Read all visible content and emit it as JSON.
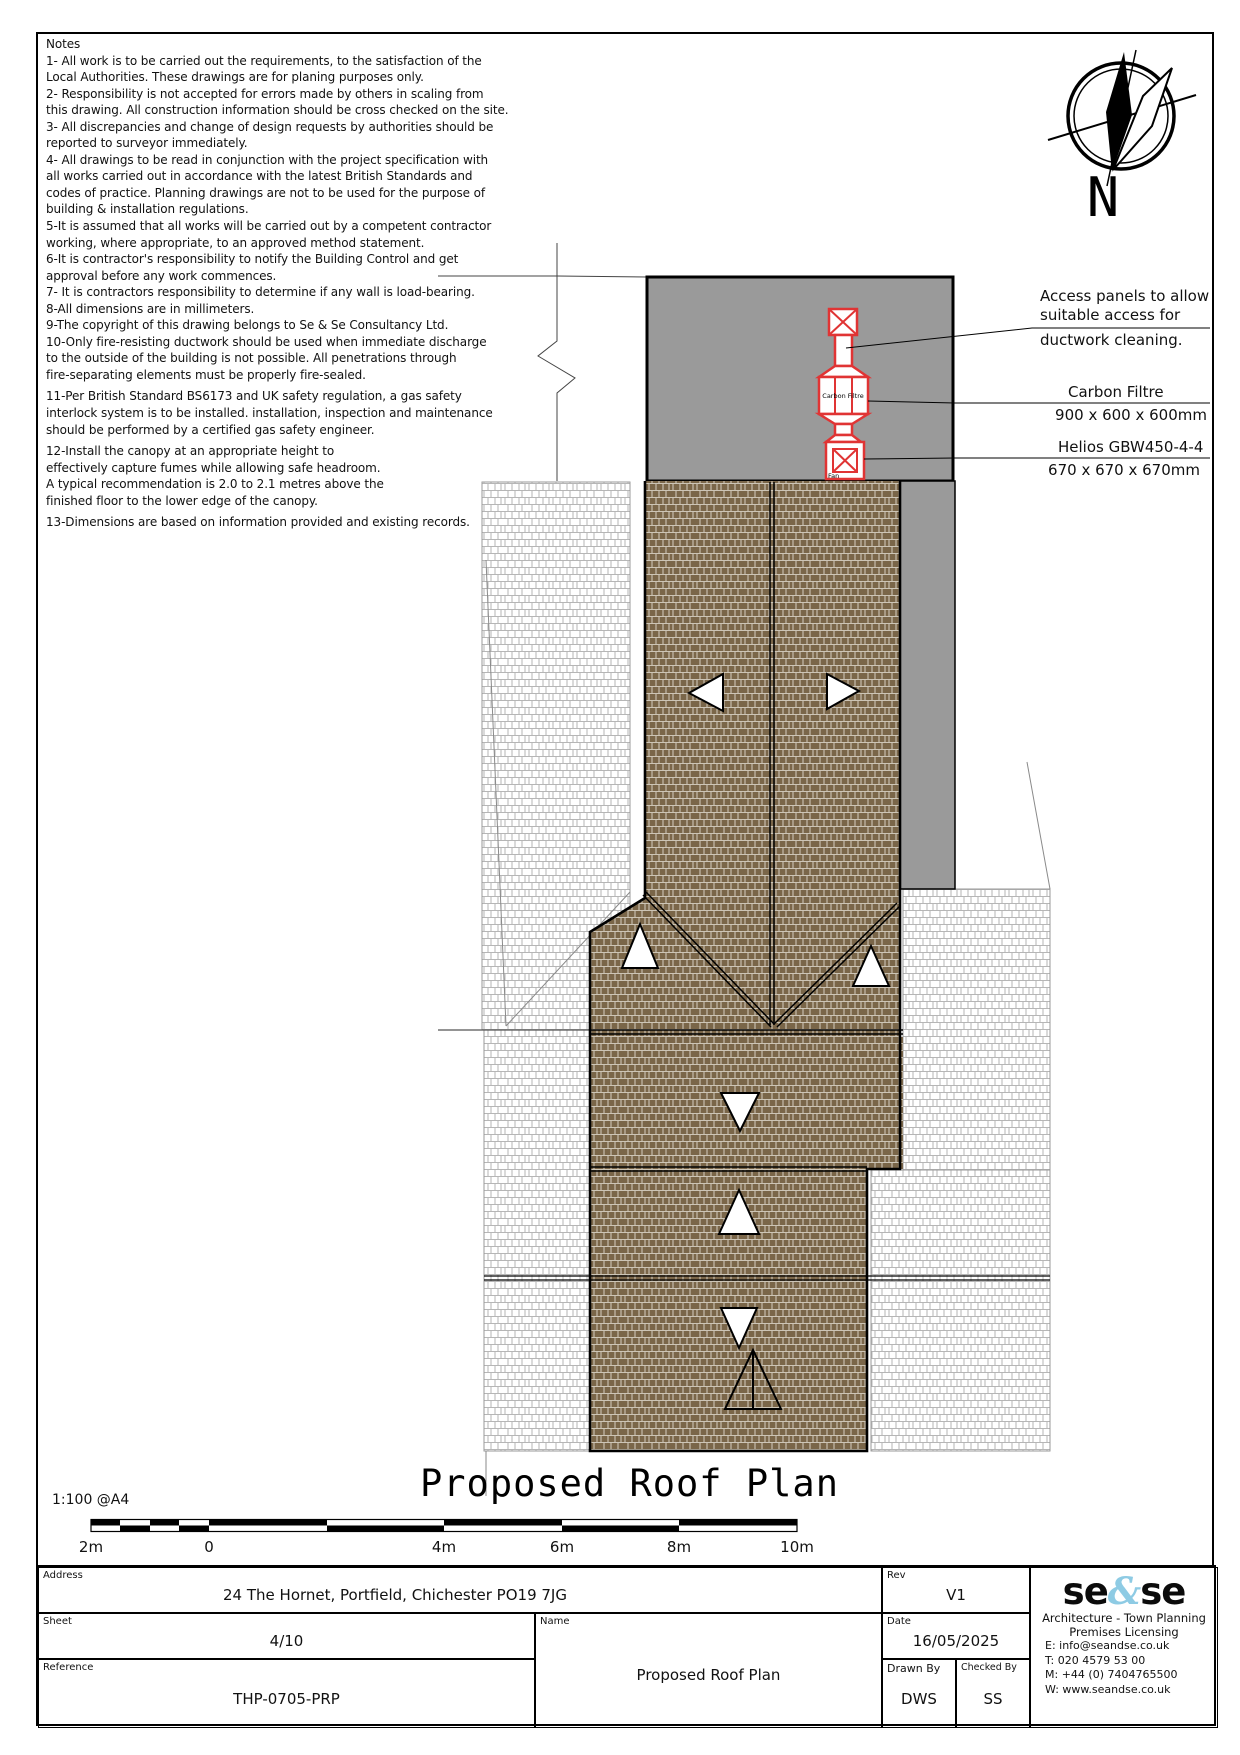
{
  "notes": {
    "title": "Notes",
    "lines": [
      "1- All work is to be carried out the requirements, to the satisfaction of the",
      "Local Authorities. These drawings are for planing purposes only.",
      "2- Responsibility is not accepted for errors made by others in scaling from",
      "this drawing. All construction information should be cross checked on the site.",
      "3- All discrepancies and change of design requests by authorities should be",
      "reported to surveyor immediately.",
      "4- All drawings to be read in conjunction with the project specification with",
      "all works carried out in accordance with the latest British Standards and",
      "codes of practice. Planning drawings are not to be used for the purpose of",
      "building & installation regulations.",
      "5-It is assumed that all works will be carried out by a competent contractor",
      "working, where appropriate, to an approved method statement.",
      "6-It is contractor's responsibility to notify the Building Control and get",
      "approval before any work commences.",
      "7- It is contractors responsibility to determine if any wall is load-bearing.",
      "8-All dimensions are in millimeters.",
      "9-The copyright of this drawing belongs to Se & Se Consultancy Ltd.",
      "10-Only fire-resisting ductwork should be used when immediate discharge",
      "to the outside of the building is not possible. All penetrations through",
      "fire-separating elements must be properly fire-sealed.",
      "11-Per British Standard BS6173 and UK safety regulation, a gas safety",
      "interlock system is to be installed. installation, inspection and maintenance",
      "should be performed by a certified gas safety engineer.",
      "12-Install the canopy at an appropriate height to",
      "effectively capture fumes while allowing safe headroom.",
      "A typical recommendation is 2.0 to 2.1 metres above the",
      "finished floor to the lower edge of the canopy.",
      "13-Dimensions are based on information provided and existing records."
    ]
  },
  "compass": {
    "label": "N"
  },
  "annotations": {
    "access_line1": "Access panels to allow",
    "access_line2": "suitable access for",
    "access_line3": "ductwork cleaning.",
    "carbon_name": "Carbon Filtre",
    "carbon_dims": "900 x 600 x 600mm",
    "fan_name": "Helios GBW450-4-4",
    "fan_dims": "670 x 670 x 670mm"
  },
  "plan_labels": {
    "carbon_filtre": "Carbon Filtre",
    "fan": "Fan"
  },
  "drawing_title": "Proposed Roof Plan",
  "scale": {
    "caption": "1:100 @A4",
    "labels": [
      "2m",
      "0",
      "4m",
      "6m",
      "8m",
      "10m"
    ]
  },
  "title_block": {
    "address_label": "Address",
    "address": "24 The Hornet, Portfield, Chichester PO19 7JG",
    "sheet_label": "Sheet",
    "sheet": "4/10",
    "reference_label": "Reference",
    "reference": "THP-0705-PRP",
    "name_label": "Name",
    "name": "Proposed Roof Plan",
    "rev_label": "Rev",
    "rev": "V1",
    "date_label": "Date",
    "date": "16/05/2025",
    "drawn_by_label": "Drawn By",
    "drawn_by": "DWS",
    "checked_by_label": "Checked By",
    "checked_by": "SS",
    "company": {
      "logo_left": "se",
      "logo_amp": "&",
      "logo_right": "se",
      "tagline1": "Architecture - Town Planning",
      "tagline2": "Premises Licensing",
      "email": "E: info@seandse.co.uk",
      "tel": "T: 020 4579 53 00",
      "mobile": "M: +44 (0) 7404765500",
      "web": "W: www.seandse.co.uk"
    }
  },
  "colors": {
    "roof_brown": "#7a6649",
    "flat_gray": "#9a9a9a",
    "duct_red": "#e03434",
    "logo_blue": "#8ecbe4"
  }
}
